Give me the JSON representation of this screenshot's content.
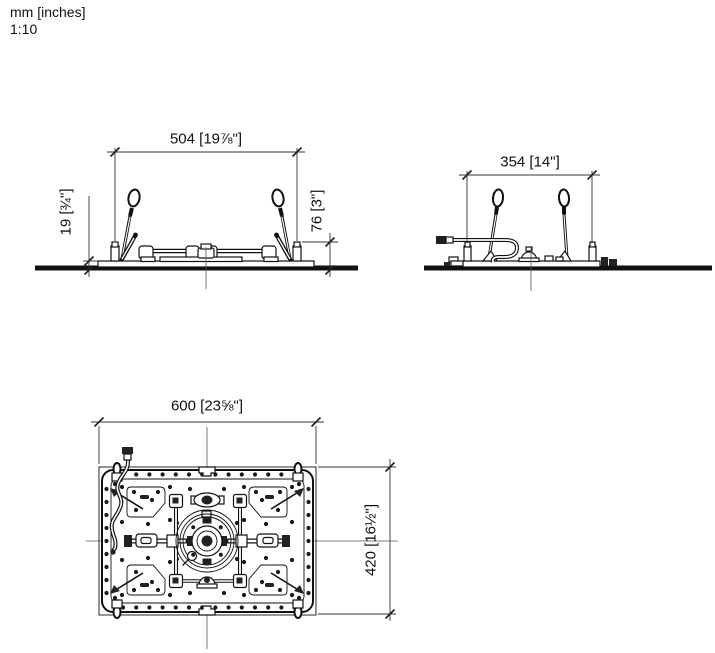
{
  "meta": {
    "units_label": "mm [inches]",
    "scale_label": "1:10"
  },
  "views": {
    "front": {
      "dim_width_label": "504 [19⅞\"]",
      "dim_reveal_label": "19 [¾\"]",
      "dim_height_label": "76 [3\"]"
    },
    "side": {
      "dim_width_label": "354 [14\"]"
    },
    "plan": {
      "dim_width_label": "600 [23⅝\"]",
      "dim_height_label": "420 [16½\"]"
    }
  },
  "colors": {
    "line": "#111111",
    "background": "#ffffff"
  }
}
